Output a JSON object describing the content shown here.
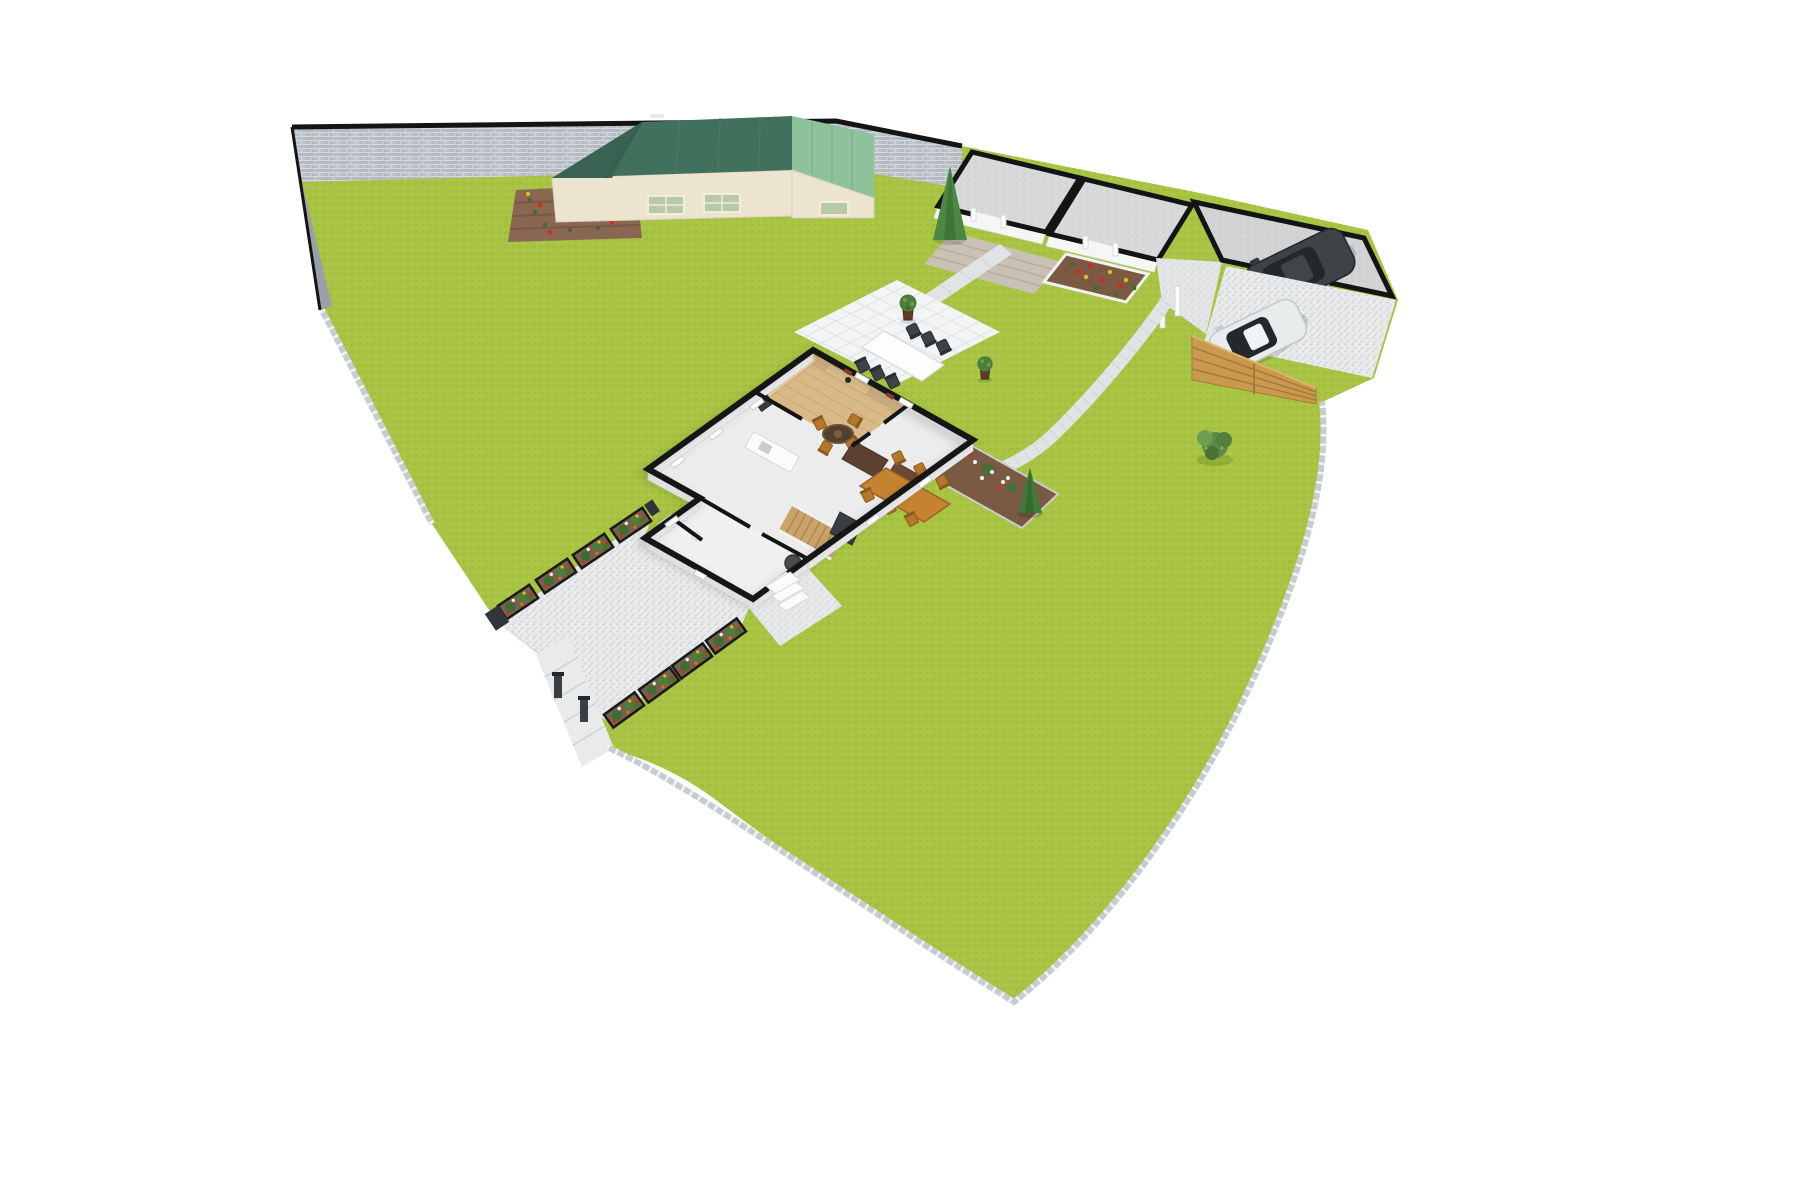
{
  "scene": {
    "description": "3D isometric site plan of a residential plot: cutaway ground floor of a house, garden shed, two-room outbuilding, garage with dark SUV, white hatchback on rear drive, gravel driveway with gated entrance, paved patio with outdoor dining set, lawns, paths and flower borders",
    "view": "isometric-3d-floor-plan",
    "background": "#ffffff"
  },
  "colors": {
    "lawn": "#a8c442",
    "stone_wall": "#b6bcc3",
    "wall_top": "#141414",
    "boundary_fence": "#c7ccd0",
    "driveway": "#e9eaeb",
    "path": "#e2e3e4",
    "patio": "#f3f4f5",
    "shed_roof_dark": "#41705c",
    "shed_roof_light": "#8ec29b",
    "shed_wall": "#ece4cf",
    "shed_window": "#b9c9a8",
    "deck": "#c8c1b4",
    "room_floor": "#d8d9da",
    "garage_floor": "#d2d3d5",
    "house_floor": "#ececed",
    "wing_floor": "#f0f0f0",
    "wood_floor": "#dab988",
    "kitchen_cabinet": "#e8cf9f",
    "stairs": "#c9a369",
    "dark_furniture": "#5d4030",
    "dining_wood": "#c6832f",
    "sofa_gray": "#4a4e52",
    "soil": "#8a6752",
    "planter_soil": "#7a5f4c",
    "mulch": "#7a5a43",
    "bush_green": "#4c7d3b",
    "topiary_green": "#3f7a37",
    "flower_red": "#cf2b20",
    "flower_yellow": "#e8b820",
    "flower_white": "#f5f5f0",
    "wooden_fence": "#c9994f",
    "suv_body": "#3f4347",
    "car_body": "#e9ecec",
    "glass": "#24272b",
    "gate_post": "#3a3f41",
    "white_post": "#fafbfb"
  },
  "objects": {
    "house": {
      "label": "main house, ground floor cutaway",
      "rooms": [
        "kitchen",
        "dining / living room",
        "hallway with staircase",
        "utility and bathroom wing"
      ],
      "furniture": [
        "kitchen cabinets",
        "fridge",
        "sink counter",
        "round breakfast table with 4 chairs",
        "staircase",
        "tv unit",
        "dresser",
        "sideboard",
        "dining table with 6 chairs",
        "armchair"
      ]
    },
    "garden_shed": {
      "label": "garden shed",
      "sections": 2,
      "roofs": [
        "dark green gable",
        "light green lean-to"
      ]
    },
    "outbuilding": {
      "label": "two-room outbuilding",
      "features": [
        "wooden deck",
        "raised flower bed"
      ]
    },
    "garage": {
      "label": "single garage",
      "vehicle": "dark SUV"
    },
    "parked_car": {
      "label": "white hatchback on rear driveway"
    },
    "patio": {
      "label": "paved patio",
      "furniture": "outdoor table with 6 chairs",
      "potted_plants": 2
    },
    "driveway": {
      "label": "gravel driveway",
      "planter_rows": 2,
      "planter_boxes": 8,
      "gate_posts": 2
    },
    "vegetable_patch": {
      "label": "tilled flower patch by boundary wall"
    },
    "rose_border": {
      "label": "mulched rose border with cone topiary beside house"
    },
    "trees": [
      "conifer cone tree",
      "garden bush"
    ],
    "boundaries": [
      "stone wall north",
      "picket fence west south east",
      "timber slat fence east"
    ]
  }
}
